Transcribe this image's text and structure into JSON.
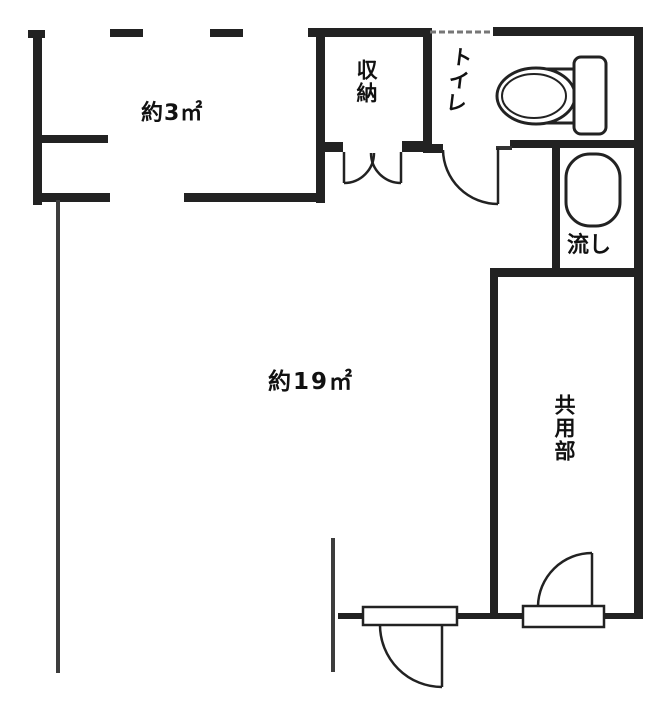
{
  "floorplan": {
    "type": "apartment-floor-plan",
    "rooms": {
      "small_room": {
        "label": "約3㎡"
      },
      "main_room": {
        "label": "約19㎡"
      },
      "storage": {
        "label": "収納"
      },
      "toilet": {
        "label": "トイレ"
      },
      "sink": {
        "label": "流し"
      },
      "common_area": {
        "label": "共用部"
      }
    },
    "fixtures": [
      {
        "name": "toilet-icon"
      },
      {
        "name": "sink-basin-icon"
      }
    ],
    "doors": [
      {
        "name": "storage-double-door"
      },
      {
        "name": "toilet-door"
      },
      {
        "name": "main-entry-door"
      },
      {
        "name": "common-area-door"
      }
    ],
    "colors": {
      "wall": "#222222",
      "thin_line": "#3d3d3d",
      "light_line": "#777777",
      "background": "#ffffff",
      "text": "#111111"
    }
  }
}
